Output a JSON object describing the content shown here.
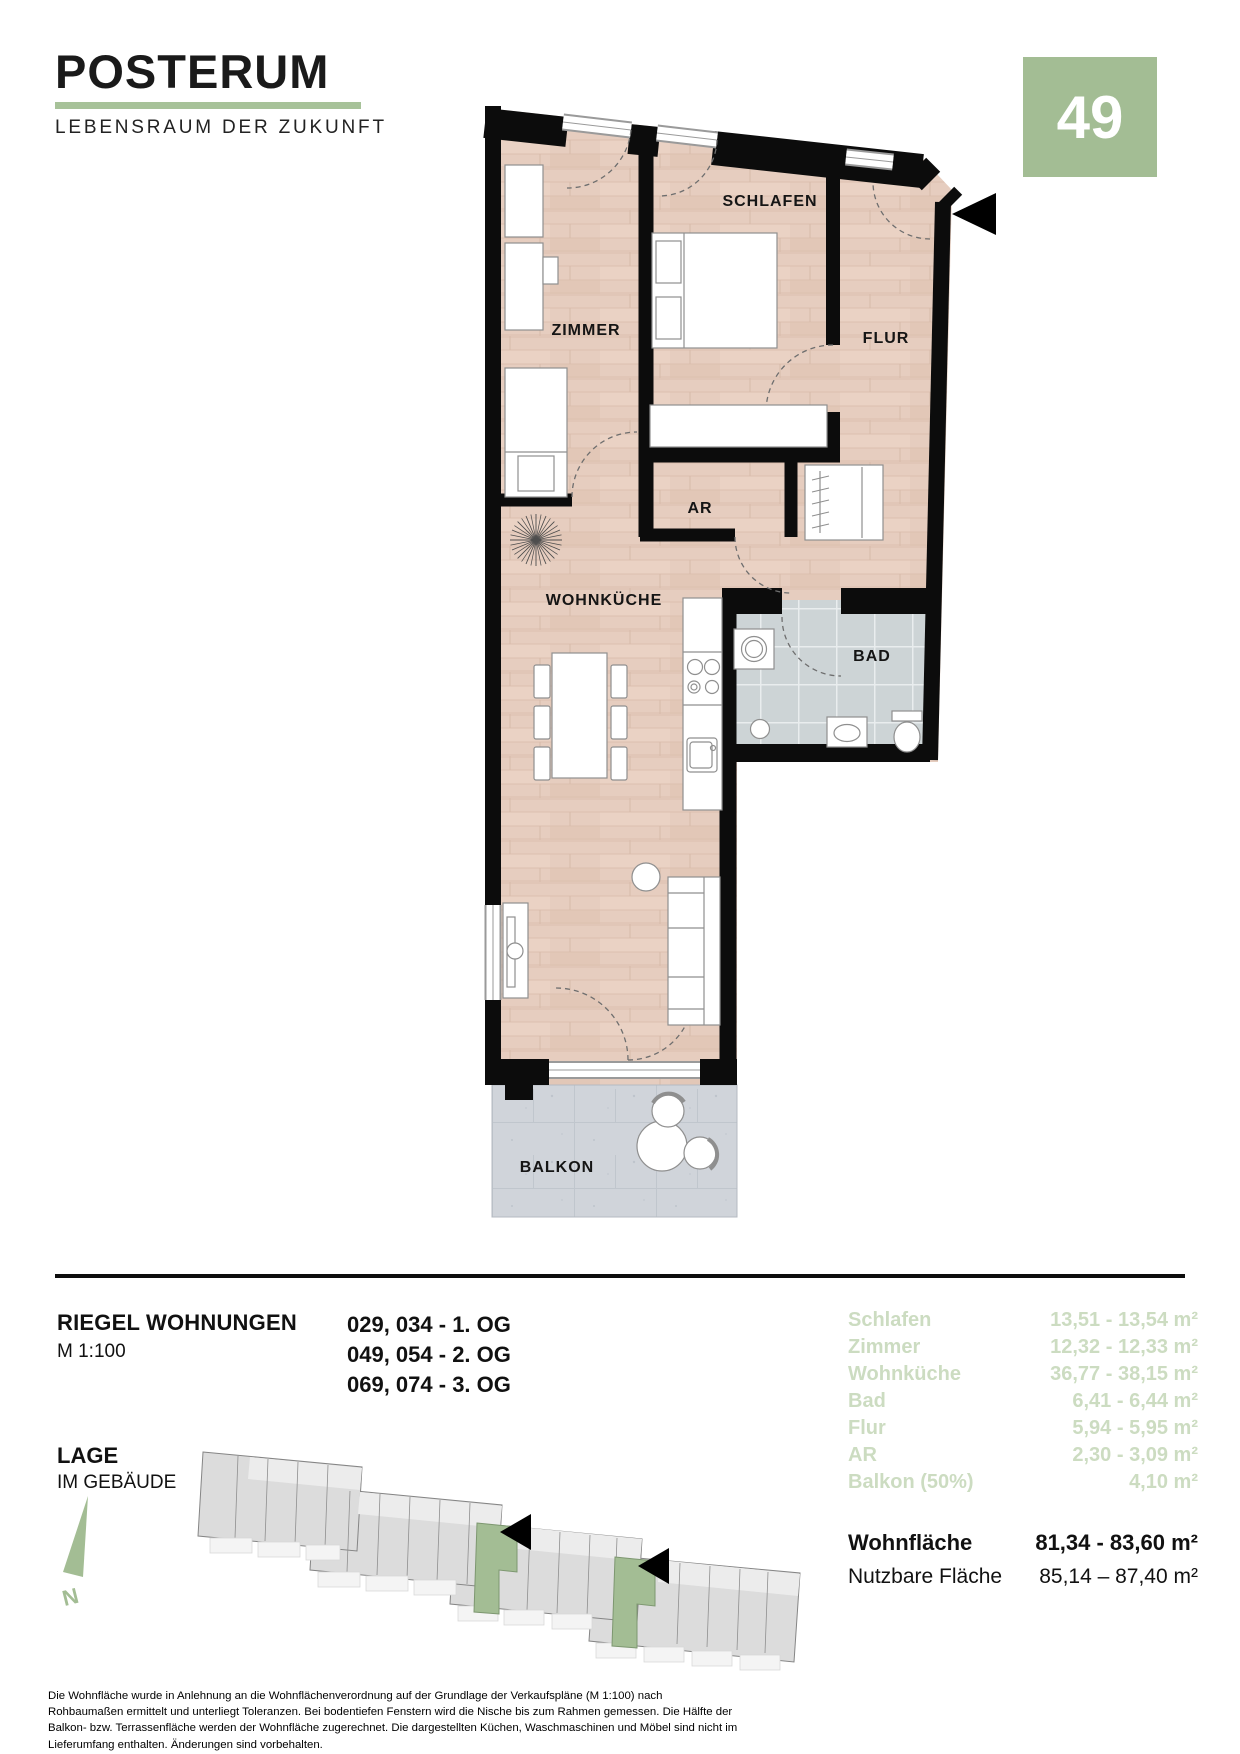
{
  "brand": {
    "name": "POSTERUM",
    "tagline": "LEBENSRAUM DER ZUKUNFT"
  },
  "unit_badge": {
    "number": "49"
  },
  "floorplan": {
    "room_labels": {
      "schlafen": "SCHLAFEN",
      "zimmer": "ZIMMER",
      "flur": "FLUR",
      "ar": "AR",
      "wohnkueche": "WOHNKÜCHE",
      "bad": "BAD",
      "balkon": "BALKON"
    }
  },
  "info": {
    "type_title": "RIEGEL WOHNUNGEN",
    "scale": "M 1:100",
    "units_floors": [
      "029, 034 - 1. OG",
      "049, 054 - 2. OG",
      "069, 074 - 3. OG"
    ],
    "location_title": "LAGE",
    "location_subtitle": "IM GEBÄUDE",
    "north_label": "N"
  },
  "areas": {
    "rows": [
      {
        "label": "Schlafen",
        "value": "13,51 - 13,54 m²"
      },
      {
        "label": "Zimmer",
        "value": "12,32 - 12,33 m²"
      },
      {
        "label": "Wohnküche",
        "value": "36,77 - 38,15 m²"
      },
      {
        "label": "Bad",
        "value": "6,41 - 6,44 m²"
      },
      {
        "label": "Flur",
        "value": "5,94 - 5,95 m²"
      },
      {
        "label": "AR",
        "value": "2,30 - 3,09 m²"
      },
      {
        "label": "Balkon (50%)",
        "value": "4,10 m²"
      }
    ],
    "totals": [
      {
        "label": "Wohnfläche",
        "value": "81,34 - 83,60 m²"
      },
      {
        "label": "Nutzbare Fläche",
        "value": "85,14 – 87,40 m²"
      }
    ]
  },
  "disclaimer": "Die Wohnfläche wurde in Anlehnung an die Wohnflächenverordnung auf der Grundlage der Verkaufspläne (M 1:100) nach Rohbaumaßen ermittelt und unterliegt Toleranzen. Bei bodentiefen Fenstern wird die Nische bis zum Rahmen gemessen. Die Hälfte der Balkon- bzw. Terrassenfläche werden der Wohnfläche zugerechnet. Die dargestellten Küchen, Waschmaschinen und Möbel sind nicht im Lieferumfang enthalten. Änderungen sind vorbehalten.",
  "colors": {
    "accent": "#a3bd94",
    "accent_light": "#ccdcc1",
    "floor_wood": "#e6cdbf",
    "bath_tile": "#cdd4d6",
    "balcony_concrete": "#d0d4da"
  }
}
